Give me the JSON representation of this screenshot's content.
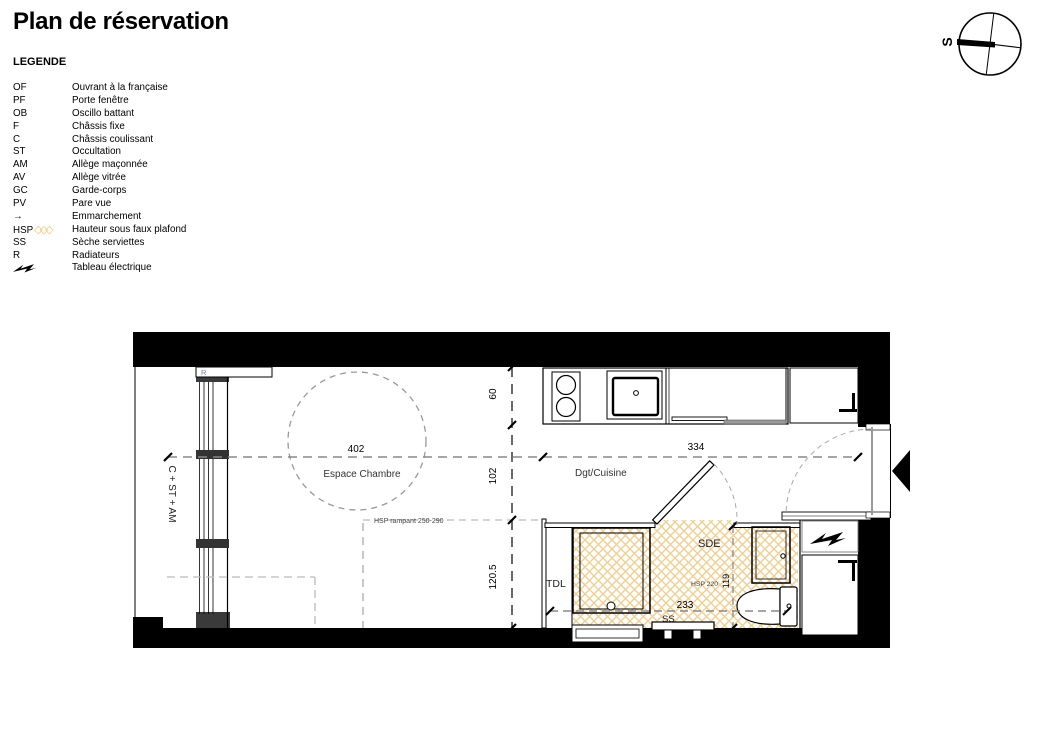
{
  "page_title": "Plan de réservation",
  "legend": {
    "heading": "LEGENDE",
    "items": [
      {
        "abbr": "OF",
        "desc": "Ouvrant à la française"
      },
      {
        "abbr": "PF",
        "desc": "Porte fenêtre"
      },
      {
        "abbr": "OB",
        "desc": "Oscillo battant"
      },
      {
        "abbr": "F",
        "desc": "Châssis fixe"
      },
      {
        "abbr": "C",
        "desc": "Châssis coulissant"
      },
      {
        "abbr": "ST",
        "desc": "Occultation"
      },
      {
        "abbr": "AM",
        "desc": "Allège maçonnée"
      },
      {
        "abbr": "AV",
        "desc": "Allège vitrée"
      },
      {
        "abbr": "GC",
        "desc": "Garde-corps"
      },
      {
        "abbr": "PV",
        "desc": "Pare vue"
      },
      {
        "abbr": "→",
        "desc": "Emmarchement",
        "icon": "arrow-right-icon"
      },
      {
        "abbr": "HSP",
        "desc": "Hauteur sous faux plafond",
        "swatch": "◇◇◇",
        "icon": "hatch-swatch"
      },
      {
        "abbr": "SS",
        "desc": "Sèche serviettes"
      },
      {
        "abbr": "R",
        "desc": "Radiateurs"
      },
      {
        "abbr": "",
        "desc": "Tableau électrique",
        "icon": "lightning-icon"
      }
    ]
  },
  "compass": {
    "label": "S"
  },
  "plan": {
    "labels": {
      "radiator": "R",
      "window_left": "C + ST + AM",
      "room_chambre": "Espace Chambre",
      "room_cuisine": "Dgt/Cuisine",
      "room_sde": "SDE",
      "room_tdl": "TDL",
      "hsp_rampant": "HSP rampant 250-290",
      "hsp_sde": "HSP 220",
      "towel_radiator": "SS"
    },
    "dimensions": {
      "width_chambre": "402",
      "width_cuisine": "334",
      "depth_kitchen": "60",
      "depth_corridor": "102",
      "depth_sde": "120.5",
      "sde_width": "233",
      "sde_height": "119"
    }
  },
  "colors": {
    "hatch": "#efcf92",
    "wall": "#000000",
    "dash_gray": "#888888",
    "dash_light": "#bbbbbb"
  }
}
